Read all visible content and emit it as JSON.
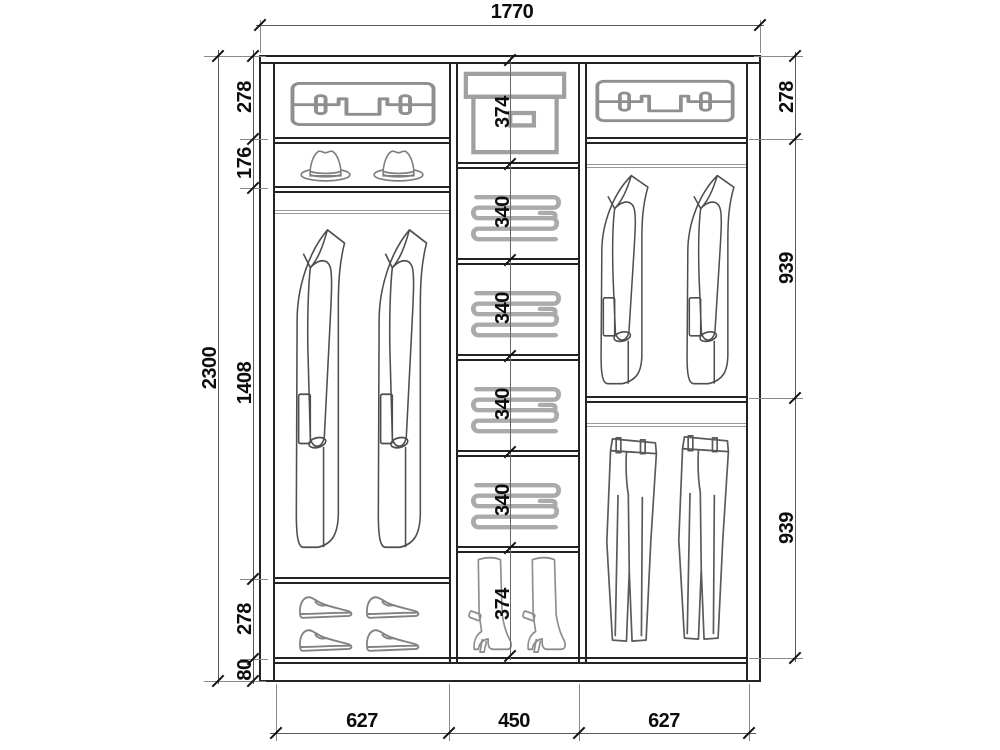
{
  "diagram": {
    "kind": "wardrobe interior elevation drawing",
    "background": "#ffffff"
  },
  "dims": {
    "total_width": "1770",
    "total_height": "2300",
    "left": [
      "278",
      "176",
      "1408",
      "278",
      "80"
    ],
    "right": [
      "278",
      "939",
      "939"
    ],
    "middle": [
      "374",
      "340",
      "340",
      "340",
      "340",
      "374"
    ],
    "bottom": [
      "627",
      "450",
      "627"
    ]
  },
  "icons": {
    "suitcase": "suitcase-icon",
    "hat": "fedora-hat-icon",
    "coat": "overcoat-icon",
    "folded_clothes": "folded-clothes-stack-icon",
    "storage_box": "storage-box-icon",
    "shoe": "dress-shoe-icon",
    "boot": "high-heel-boot-icon",
    "jacket": "suit-jacket-icon",
    "trousers": "trousers-icon"
  },
  "colors": {
    "structure_line": "#232323",
    "dimension_line": "#5a5a5a",
    "label_text": "#0d0d0d",
    "icon_gray": "#8f8f8f"
  }
}
